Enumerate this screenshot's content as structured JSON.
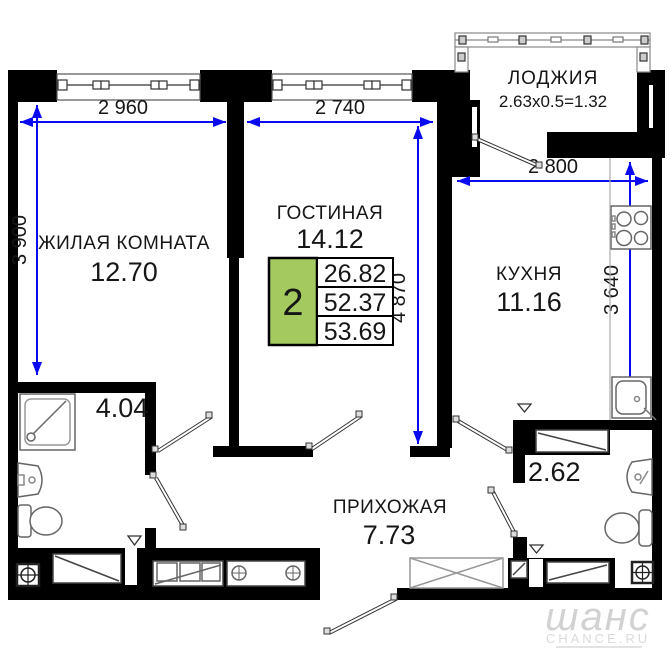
{
  "plan_title": "floor-plan",
  "colors": {
    "wall": "#000000",
    "dimension_line": "#0a0af0",
    "summary_fill": "#a3c95f",
    "background": "#ffffff",
    "watermark": "#d2d2d2"
  },
  "rooms": [
    {
      "id": "living-room",
      "label": "ЖИЛАЯ КОМНАТА",
      "area": "12.70"
    },
    {
      "id": "lounge",
      "label": "ГОСТИНАЯ",
      "area": "14.12"
    },
    {
      "id": "loggia",
      "label": "ЛОДЖИЯ",
      "area": "2.63x0.5=1.32"
    },
    {
      "id": "kitchen",
      "label": "КУХНЯ",
      "area": "11.16"
    },
    {
      "id": "hallway",
      "label": "ПРИХОЖАЯ",
      "area": "7.73"
    },
    {
      "id": "bathroom",
      "label": "",
      "area": "4.04"
    },
    {
      "id": "wc",
      "label": "",
      "area": "2.62"
    }
  ],
  "dimensions": {
    "living_width": "2 960",
    "lounge_width": "2 740",
    "kitchen_width": "2 800",
    "living_height": "3 900",
    "lounge_height": "4 870",
    "kitchen_height": "3 640"
  },
  "summary": {
    "room_count": "2",
    "living_area": "26.82",
    "area_without_loggia": "52.37",
    "total_area": "53.69"
  },
  "watermark": {
    "script": "шанс",
    "caption": "CHANCE.RU"
  }
}
